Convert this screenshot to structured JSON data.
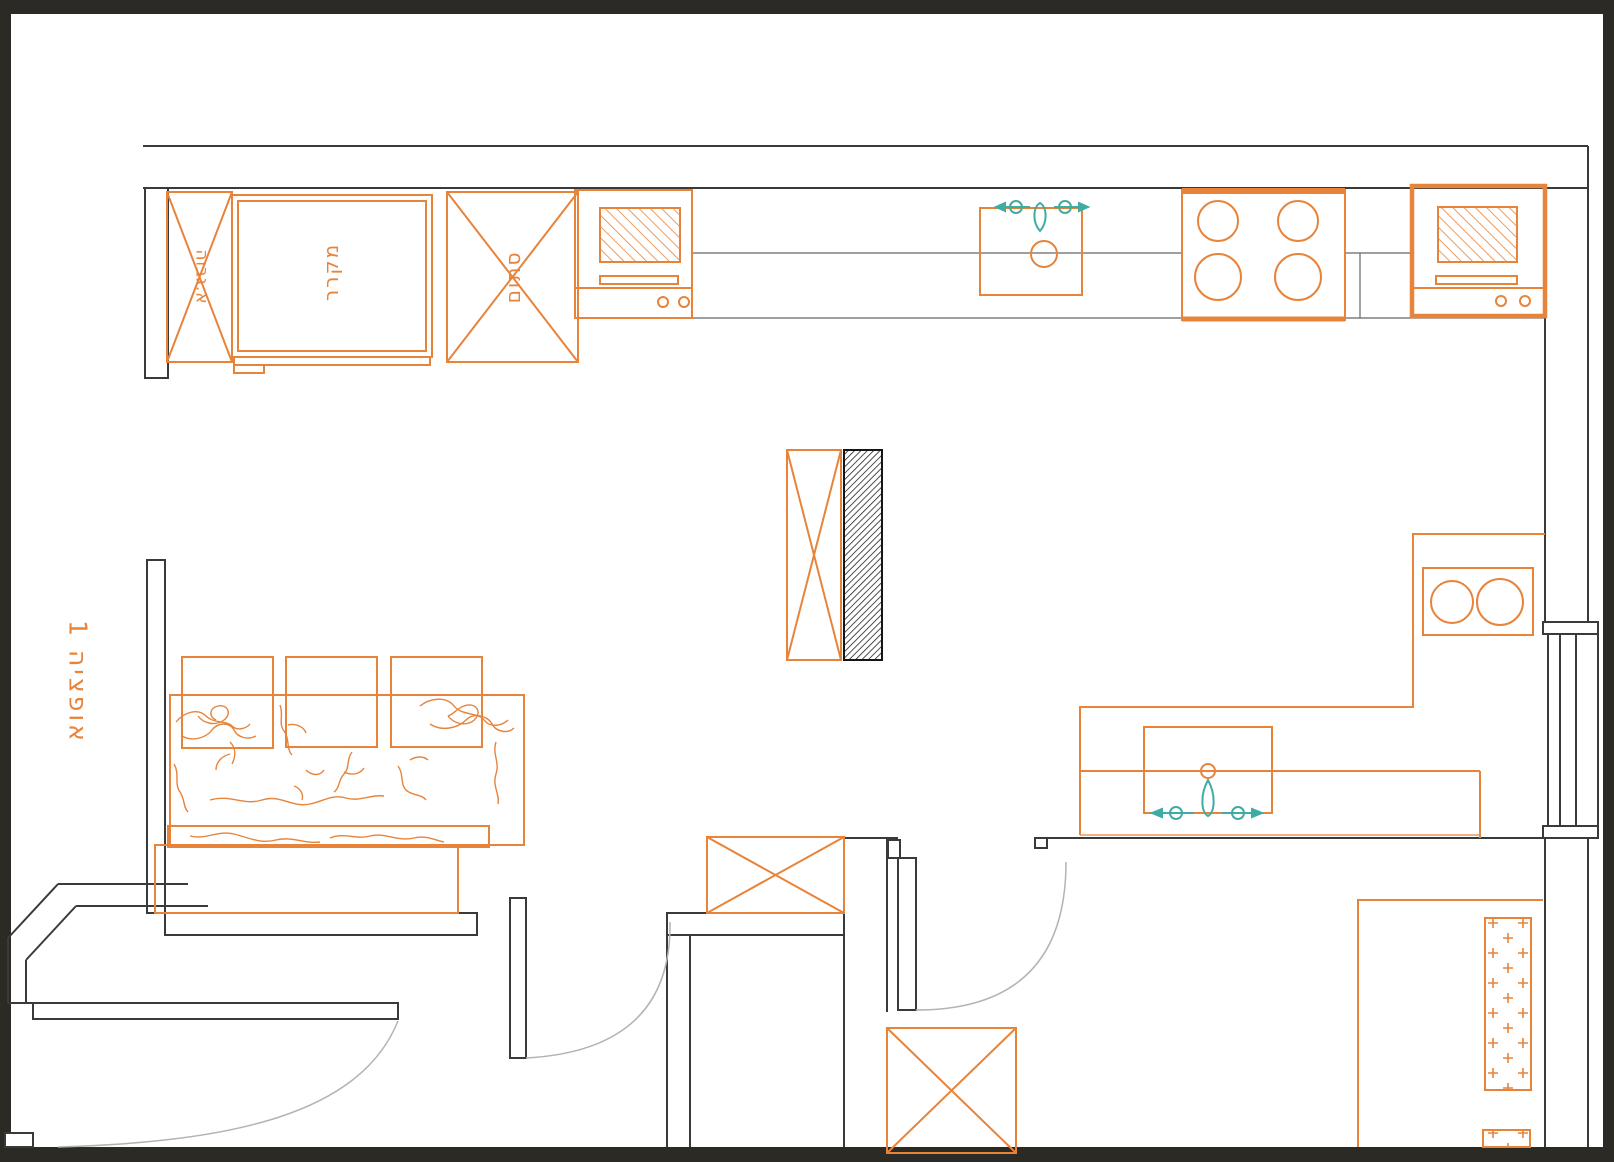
{
  "page": {
    "type": "kitchen-floor-plan-option",
    "option_label": "אופציה 1"
  },
  "labels": {
    "tall_cabinet": "א.גבוה",
    "refrigerator": "מקרר",
    "blocked_cabinet": "סתום"
  },
  "colors": {
    "cabinetry_orange": "#E8833A",
    "plumbing_teal": "#3FACA4",
    "walls_dark": "#3A3A3A",
    "frame_background": "#2B2A24",
    "door_swing_gray": "#B3B3B3",
    "paper_white": "#FFFFFF",
    "column_hatch_black": "#151515"
  },
  "fixtures": {
    "top_run": [
      "tall-cabinet",
      "refrigerator",
      "blocked-cabinet",
      "built-in-oven",
      "kitchen-sink",
      "cooktop-4-burner",
      "built-in-oven-heavy"
    ],
    "center": [
      "island-with-3-stools",
      "structural-column"
    ],
    "right_run": [
      "double-bowl-fixture",
      "peninsula-sink"
    ],
    "openings": [
      "entry-door-left",
      "interior-door-center",
      "interior-door-right",
      "window-right-wall"
    ]
  }
}
